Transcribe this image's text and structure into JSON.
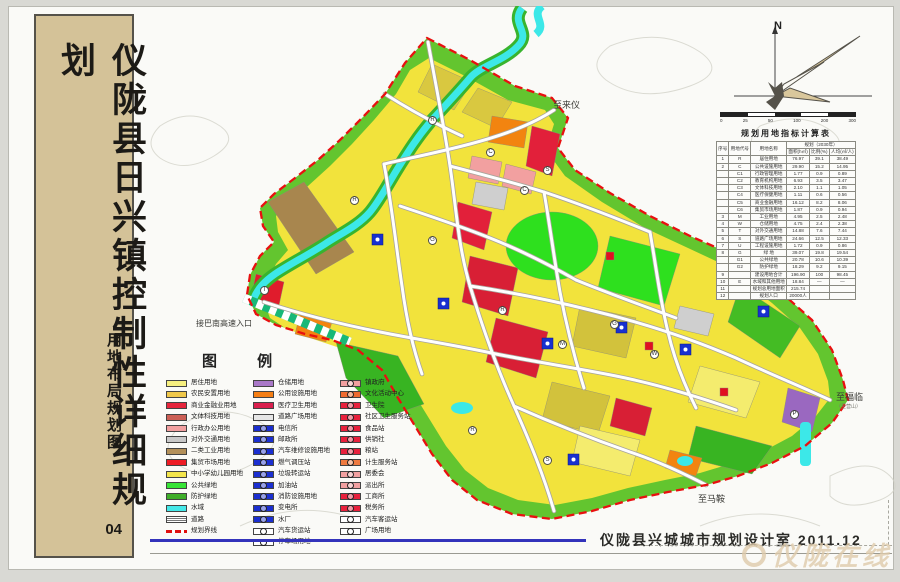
{
  "sidebar": {
    "title": "仪陇县日兴镇控制性详细规划",
    "subtitle": "用地布局规划图",
    "sheet_number": "04"
  },
  "credit": {
    "designer": "仪陇县兴城城市规划设计室",
    "date": "2011.12"
  },
  "watermark": {
    "text": "仪陇在线"
  },
  "compass": {
    "north_label": "N"
  },
  "scalebar": {
    "ticks": [
      "0",
      "25",
      "50",
      "100",
      "200",
      "300"
    ]
  },
  "colors": {
    "residential_yellow": "#f2e33c",
    "commercial_red": "#d81f35",
    "green_space": "#2ee01e",
    "water_cyan": "#3ce8e8",
    "boundary_red": "#e81010",
    "sidebar_tan": "#d4c298",
    "blue_utility": "#1830d0"
  },
  "map": {
    "annotations": [
      {
        "text": "至来仪",
        "sub": "",
        "x": 553,
        "y": 98,
        "size": 9
      },
      {
        "text": "接巴南高速入口",
        "sub": "",
        "x": 196,
        "y": 318,
        "size": 8
      },
      {
        "text": "至福临",
        "sub": "（至营山）",
        "x": 836,
        "y": 390,
        "size": 9
      },
      {
        "text": "至马鞍",
        "sub": "",
        "x": 698,
        "y": 492,
        "size": 9
      }
    ],
    "markers": [
      {
        "glyph": "C",
        "x": 486,
        "y": 148
      },
      {
        "glyph": "C",
        "x": 520,
        "y": 186
      },
      {
        "glyph": "S",
        "x": 543,
        "y": 166
      },
      {
        "glyph": "G",
        "x": 428,
        "y": 236
      },
      {
        "glyph": "R",
        "x": 350,
        "y": 196
      },
      {
        "glyph": "R",
        "x": 498,
        "y": 306
      },
      {
        "glyph": "M",
        "x": 558,
        "y": 340
      },
      {
        "glyph": "G",
        "x": 610,
        "y": 320
      },
      {
        "glyph": "W",
        "x": 650,
        "y": 350
      },
      {
        "glyph": "R",
        "x": 468,
        "y": 426
      },
      {
        "glyph": "S",
        "x": 543,
        "y": 456
      },
      {
        "glyph": "T",
        "x": 260,
        "y": 286
      },
      {
        "glyph": "R",
        "x": 428,
        "y": 116
      },
      {
        "glyph": "P",
        "x": 790,
        "y": 410
      }
    ]
  },
  "legend": {
    "title": "图  例",
    "columns": [
      [
        {
          "label": "居住用地",
          "color": "#f7f080",
          "type": "fill"
        },
        {
          "label": "农民安置用地",
          "color": "#f0c84a",
          "type": "fill"
        },
        {
          "label": "商业金融业用地",
          "color": "#e6253c",
          "type": "fill"
        },
        {
          "label": "文体科技用地",
          "color": "#cc5f55",
          "type": "fill"
        },
        {
          "label": "行政办公用地",
          "color": "#f2a0a0",
          "type": "fill"
        },
        {
          "label": "对外交通用地",
          "color": "#c9c9c9",
          "type": "fill"
        },
        {
          "label": "二类工业用地",
          "color": "#b3905a",
          "type": "fill"
        },
        {
          "label": "集贸市场用地",
          "color": "#ee1c25",
          "type": "fill"
        },
        {
          "label": "中小学幼儿园用地",
          "color": "#f3e54c",
          "type": "fill"
        },
        {
          "label": "公共绿地",
          "color": "#37e437",
          "type": "fill"
        },
        {
          "label": "防护绿地",
          "color": "#3fae2a",
          "type": "fill"
        },
        {
          "label": "水域",
          "color": "#45e8e8",
          "type": "fill"
        },
        {
          "label": "道路",
          "color": "#bbbbbb",
          "type": "road"
        },
        {
          "label": "规划界线",
          "color": "#e01010",
          "type": "dash"
        }
      ],
      [
        {
          "label": "仓储用地",
          "color": "#a978c8",
          "type": "fill"
        },
        {
          "label": "公用设施用地",
          "color": "#f57e14",
          "type": "fill"
        },
        {
          "label": "医疗卫生用地",
          "color": "#d91f4d",
          "type": "fill"
        },
        {
          "label": "道路广场用地",
          "color": "#e6e6e6",
          "type": "fill"
        },
        {
          "label": "电信所",
          "color": "#1b2fd0",
          "type": "symbol"
        },
        {
          "label": "邮政所",
          "color": "#1b2fd0",
          "type": "symbol"
        },
        {
          "label": "汽车维修设施用地",
          "color": "#1b2fd0",
          "type": "symbol"
        },
        {
          "label": "燃气调压站",
          "color": "#1b2fd0",
          "type": "symbol"
        },
        {
          "label": "垃圾转运站",
          "color": "#1b2fd0",
          "type": "symbol"
        },
        {
          "label": "加油站",
          "color": "#1b2fd0",
          "type": "symbol"
        },
        {
          "label": "消防设施用地",
          "color": "#1b2fd0",
          "type": "symbol"
        },
        {
          "label": "变电所",
          "color": "#1b2fd0",
          "type": "symbol"
        },
        {
          "label": "水厂",
          "color": "#1b2fd0",
          "type": "symbol"
        },
        {
          "label": "汽车货运站",
          "color": "#ffffff",
          "type": "symbol-outline"
        },
        {
          "label": "停车场用地",
          "color": "#ffffff",
          "type": "symbol-outline"
        }
      ],
      [
        {
          "label": "镇政府",
          "color": "#f2a0a0",
          "type": "symbol"
        },
        {
          "label": "文化活动中心",
          "color": "#ef6a30",
          "type": "symbol"
        },
        {
          "label": "卫生院",
          "color": "#e8203c",
          "type": "symbol"
        },
        {
          "label": "社区卫生服务站",
          "color": "#e8203c",
          "type": "symbol"
        },
        {
          "label": "食品站",
          "color": "#e8203c",
          "type": "symbol"
        },
        {
          "label": "供销社",
          "color": "#e8203c",
          "type": "symbol"
        },
        {
          "label": "粮站",
          "color": "#e8203c",
          "type": "symbol"
        },
        {
          "label": "计生服务站",
          "color": "#ef7a40",
          "type": "symbol"
        },
        {
          "label": "居委会",
          "color": "#f2a0a0",
          "type": "symbol"
        },
        {
          "label": "派出所",
          "color": "#f2a0a0",
          "type": "symbol"
        },
        {
          "label": "工商所",
          "color": "#e8203c",
          "type": "symbol"
        },
        {
          "label": "税务所",
          "color": "#e8203c",
          "type": "symbol"
        },
        {
          "label": "汽车客运站",
          "color": "#ffffff",
          "type": "symbol-outline"
        },
        {
          "label": "广场用地",
          "color": "#ffffff",
          "type": "symbol-outline"
        }
      ]
    ]
  },
  "table": {
    "title": "规划用地指标计算表",
    "headers": {
      "col1": "序号",
      "col2": "用地代号",
      "col3": "用地名称",
      "group": "规划（2030年）",
      "sub": [
        "面积(h㎡)",
        "比例(%)",
        "人均(㎡/人)"
      ]
    },
    "rows": [
      [
        "1",
        "R",
        "居住用地",
        "76.97",
        "39.1",
        "38.49"
      ],
      [
        "2",
        "C",
        "公共设施用地",
        "29.90",
        "15.2",
        "14.95"
      ],
      [
        "",
        "C1",
        "行政管理用地",
        "1.77",
        "0.9",
        "0.89"
      ],
      [
        "",
        "C2",
        "教育机构用地",
        "6.93",
        "3.5",
        "3.47"
      ],
      [
        "",
        "C3",
        "文体科技用地",
        "2.10",
        "1.1",
        "1.05"
      ],
      [
        "",
        "C4",
        "医疗保健用地",
        "1.11",
        "0.6",
        "0.56"
      ],
      [
        "",
        "C5",
        "商业金融用地",
        "16.12",
        "8.2",
        "8.06"
      ],
      [
        "",
        "C6",
        "集贸市场用地",
        "1.87",
        "0.9",
        "0.94"
      ],
      [
        "3",
        "M",
        "工业用地",
        "4.95",
        "2.5",
        "2.48"
      ],
      [
        "4",
        "W",
        "仓储用地",
        "4.75",
        "2.4",
        "2.38"
      ],
      [
        "5",
        "T",
        "对外交通用地",
        "14.88",
        "7.6",
        "7.44"
      ],
      [
        "6",
        "S",
        "道路广场用地",
        "24.66",
        "12.5",
        "12.33"
      ],
      [
        "7",
        "U",
        "工程设施用地",
        "1.72",
        "0.9",
        "0.86"
      ],
      [
        "8",
        "G",
        "绿  地",
        "39.07",
        "19.8",
        "19.54"
      ],
      [
        "",
        "G1",
        "公共绿地",
        "20.78",
        "10.6",
        "10.39"
      ],
      [
        "",
        "G2",
        "防护绿地",
        "18.29",
        "9.2",
        "9.15"
      ],
      [
        "9",
        "",
        "建设用地合计",
        "196.90",
        "100",
        "98.45"
      ],
      [
        "10",
        "E",
        "水域和其他用地",
        "18.84",
        "—",
        "—"
      ],
      [
        "11",
        "",
        "规划总用地面积",
        "215.74",
        "",
        ""
      ],
      [
        "12",
        "",
        "规划人口",
        "20000人",
        "",
        ""
      ]
    ]
  }
}
